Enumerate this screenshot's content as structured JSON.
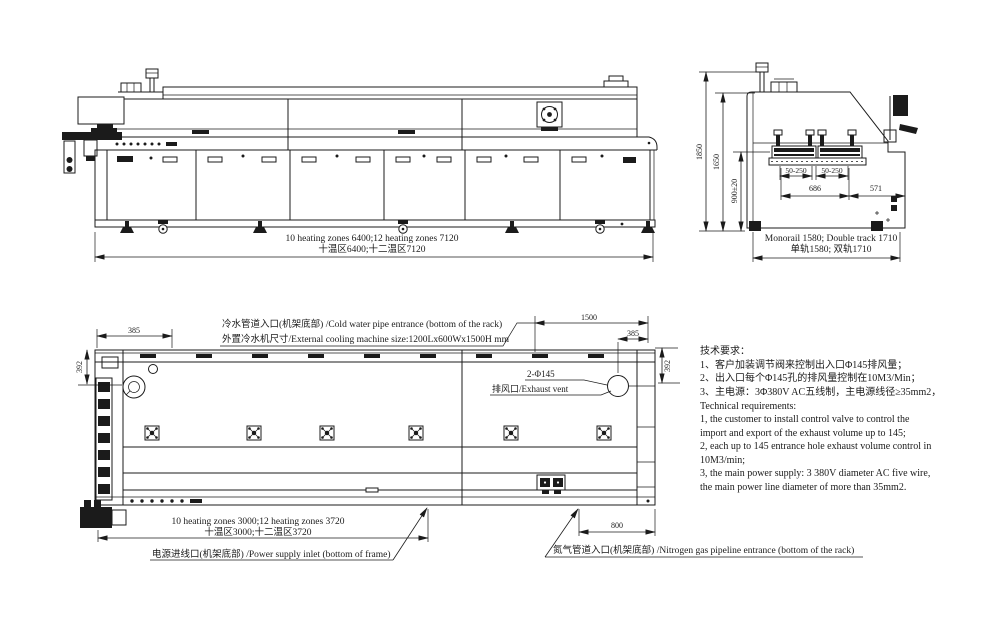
{
  "drawing": {
    "background": "#ffffff",
    "ink": "#1b1b1b"
  },
  "side_view": {
    "zones_dim_en": "10 heating zones 6400;12 heating zones 7120",
    "zones_dim_cn": "十温区6400;十二温区7120"
  },
  "end_view": {
    "height_total": "1850",
    "height_body": "1650",
    "rail_height": "900±20",
    "rail_range_left": "50-250",
    "rail_range_right": "50-250",
    "width_inner": "686",
    "width_side": "571",
    "track_dim_en": "Monorail 1580; Double track 1710",
    "track_dim_cn": "单轨1580; 双轨1710"
  },
  "plan_view": {
    "cold_water_label": "冷水管道入口(机架底部) /Cold water pipe entrance (bottom of the rack)",
    "cooling_size_label": "外置冷水机尺寸/External cooling machine size:1200Lx600Wx1500H mm",
    "dim_left_385": "385",
    "dim_left_392": "392",
    "dim_1500": "1500",
    "dim_right_385": "385",
    "dim_right_392": "392",
    "exhaust_count_label": "2-Φ145",
    "exhaust_vent_label": "排风口/Exhaust vent",
    "zones_dim_en": "10 heating zones 3000;12 heating zones 3720",
    "zones_dim_cn": "十温区3000;十二温区3720",
    "power_label": "电源进线口(机架底部) /Power supply inlet (bottom of frame)",
    "dim_800": "800",
    "nitrogen_label": "氮气管道入口(机架底部) /Nitrogen gas pipeline entrance (bottom of the rack)"
  },
  "tech_requirements": {
    "lines": [
      "技术要求：",
      "1、客户加装调节阀来控制出入口Φ145排风量；",
      "2、出入口每个Φ145孔的排风量控制在10M3/Min；",
      "3、主电源：3Φ380V AC五线制，主电源线径≥35mm2，",
      "Technical requirements:",
      "1, the customer to install control valve to control the",
      "import and export of the exhaust volume up to 145;",
      "2, each up to 145 entrance hole exhaust volume control in",
      "10M3/min;",
      "3, the main power supply: 3 380V diameter AC five wire,",
      "the main power line diameter of more than 35mm2."
    ]
  }
}
